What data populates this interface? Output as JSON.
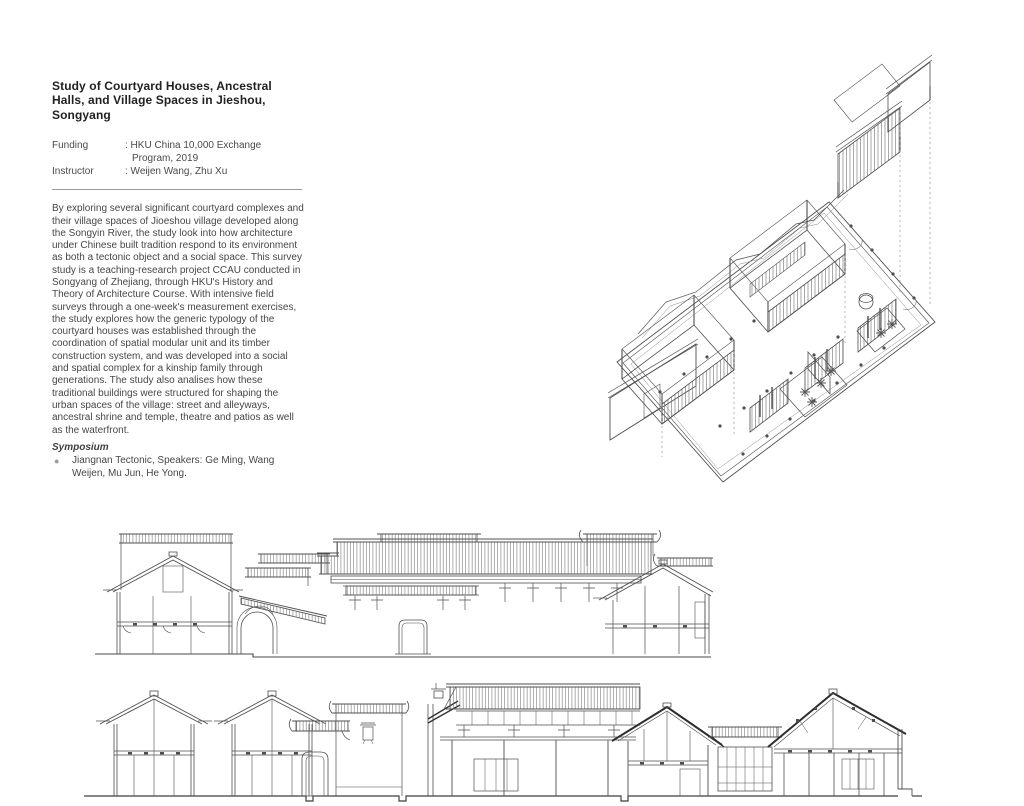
{
  "colors": {
    "background": "#ffffff",
    "text": "#3a3a3a",
    "title_text": "#222222",
    "drawing_line": "#4f4f4f",
    "drawing_line_light": "#8a8a8a",
    "bullet": "#9c9c9c"
  },
  "icons": {
    "bullet": "●"
  },
  "info": {
    "title": "Study of Courtyard Houses, Ancestral Halls, and Village Spaces in Jieshou, Songyang",
    "funding_label": "Funding",
    "funding_value_line1": ": HKU China 10,000 Exchange",
    "funding_value_line2": "Program, 2019",
    "instructor_label": "Instructor",
    "instructor_value": ": Weijen Wang, Zhu Xu",
    "description": "By exploring several significant courtyard complexes and their village spaces of Jioeshou village developed along the Songyin River, the study look into how architecture under Chinese built tradition respond to its environment as both a tectonic object and a social space. This survey study is a teaching-research project CCAU conducted in Songyang of Zhejiang, through HKU's History and Theory of Architecture Course. With intensive field surveys through a one-week's measurement exercises, the study explores how the generic typology of the courtyard houses was established through the coordination of spatial modular unit and its timber construction system, and was developed into a social and spatial complex for a kinship family through generations. The study also analises how these traditional buildings were structured for shaping the urban spaces of the village: street and alleyways, ancestral shrine and temple, theatre and patios as well as the waterfront.",
    "symposium_heading": "Symposium",
    "symposium_item": "Jiangnan Tectonic, Speakers: Ge Ming, Wang Weijen, Mu Jun, He Yong."
  }
}
